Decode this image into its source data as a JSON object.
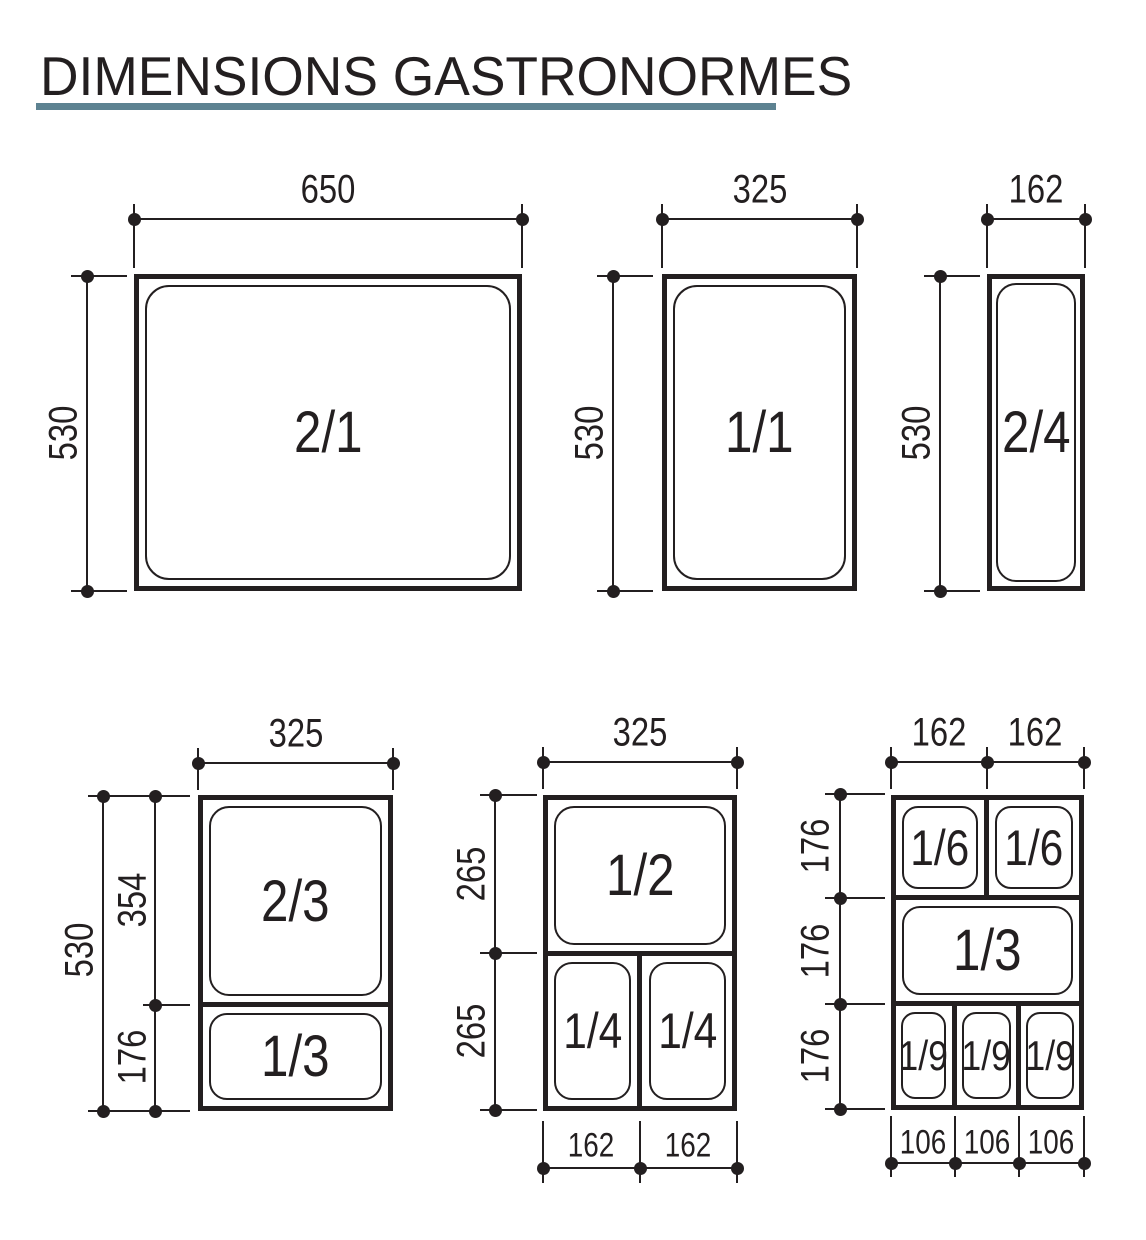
{
  "title": "DIMENSIONS GASTRONORMES",
  "colors": {
    "ink": "#231f20",
    "underline": "#5d8291",
    "background": "#ffffff"
  },
  "panels": {
    "p21": {
      "pan": "2/1",
      "width": "650",
      "height": "530"
    },
    "p11": {
      "pan": "1/1",
      "width": "325",
      "height": "530"
    },
    "p24": {
      "pan": "2/4",
      "width": "162",
      "height": "530"
    },
    "p23": {
      "pan_top": "2/3",
      "pan_bottom": "1/3",
      "width": "325",
      "height": "530",
      "height_top": "354",
      "height_bottom": "176"
    },
    "p12": {
      "pan_top": "1/2",
      "pan_bottom_left": "1/4",
      "pan_bottom_right": "1/4",
      "width": "325",
      "height_top": "265",
      "height_bottom": "265",
      "width_bottom_left": "162",
      "width_bottom_right": "162"
    },
    "p169": {
      "pan_r1c1": "1/6",
      "pan_r1c2": "1/6",
      "pan_r2": "1/3",
      "pan_r3c1": "1/9",
      "pan_r3c2": "1/9",
      "pan_r3c3": "1/9",
      "width_left": "162",
      "width_right": "162",
      "height_r1": "176",
      "height_r2": "176",
      "height_r3": "176",
      "width_b1": "106",
      "width_b2": "106",
      "width_b3": "106"
    }
  }
}
